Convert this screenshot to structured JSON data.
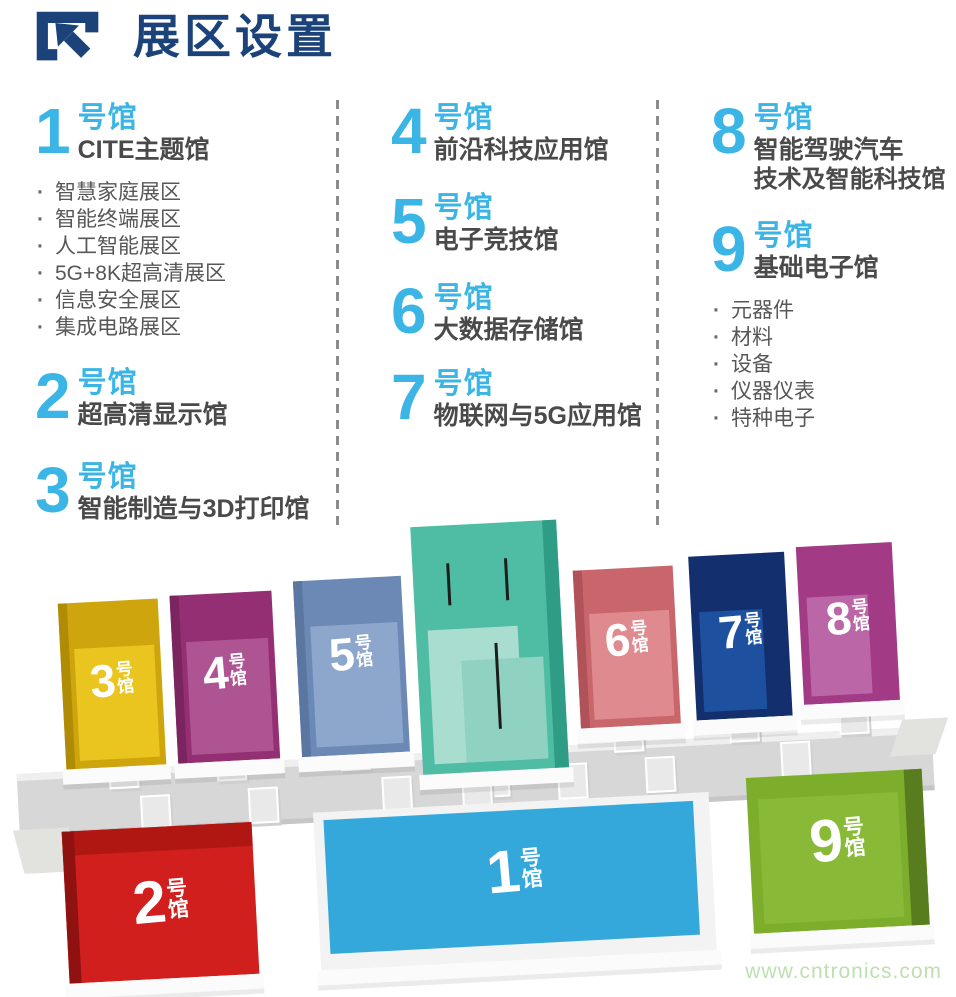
{
  "header": {
    "title": "展区设置"
  },
  "legend": {
    "bullet_char": "·",
    "columns": [
      {
        "halls": [
          {
            "number": "1",
            "suffix": "号馆",
            "name": "CITE主题馆",
            "items": [
              "智慧家庭展区",
              "智能终端展区",
              "人工智能展区",
              "5G+8K超高清展区",
              "信息安全展区",
              "集成电路展区"
            ]
          },
          {
            "number": "2",
            "suffix": "号馆",
            "name": "超高清显示馆"
          },
          {
            "number": "3",
            "suffix": "号馆",
            "name": "智能制造与3D打印馆"
          }
        ]
      },
      {
        "halls": [
          {
            "number": "4",
            "suffix": "号馆",
            "name": "前沿科技应用馆"
          },
          {
            "number": "5",
            "suffix": "号馆",
            "name": "电子竞技馆"
          },
          {
            "number": "6",
            "suffix": "号馆",
            "name": "大数据存储馆"
          },
          {
            "number": "7",
            "suffix": "号馆",
            "name": "物联网与5G应用馆"
          }
        ]
      },
      {
        "halls": [
          {
            "number": "8",
            "suffix": "号馆",
            "name_line1": "智能驾驶汽车",
            "name_line2": "技术及智能科技馆"
          },
          {
            "number": "9",
            "suffix": "号馆",
            "name": "基础电子馆",
            "items": [
              "元器件",
              "材料",
              "设备",
              "仪器仪表",
              "特种电子"
            ]
          }
        ]
      }
    ]
  },
  "map": {
    "suffix_top": "号",
    "suffix_bottom": "馆",
    "halls": [
      {
        "id": "hall-3",
        "number": "3",
        "color": "#cfa50d"
      },
      {
        "id": "hall-4",
        "number": "4",
        "color": "#932f72"
      },
      {
        "id": "hall-5",
        "number": "5",
        "color": "#6c89b5"
      },
      {
        "id": "hall-6",
        "number": "6",
        "color": "#c9666c"
      },
      {
        "id": "hall-7",
        "number": "7",
        "color": "#142f6e"
      },
      {
        "id": "hall-8",
        "number": "8",
        "color": "#a23a86"
      },
      {
        "id": "hall-2",
        "number": "2",
        "color": "#d01f1c"
      },
      {
        "id": "hall-1",
        "number": "1",
        "color": "#35a8db"
      },
      {
        "id": "hall-9",
        "number": "9",
        "color": "#7cae2c"
      }
    ],
    "central_hall_color": "#4fbca4"
  },
  "footer": {
    "watermark": "www.cntronics.com"
  },
  "colors": {
    "title_blue": "#1c4379",
    "accent_cyan": "#3bb4e6",
    "text_dark": "#4a4a4a",
    "text_body": "#575757"
  }
}
